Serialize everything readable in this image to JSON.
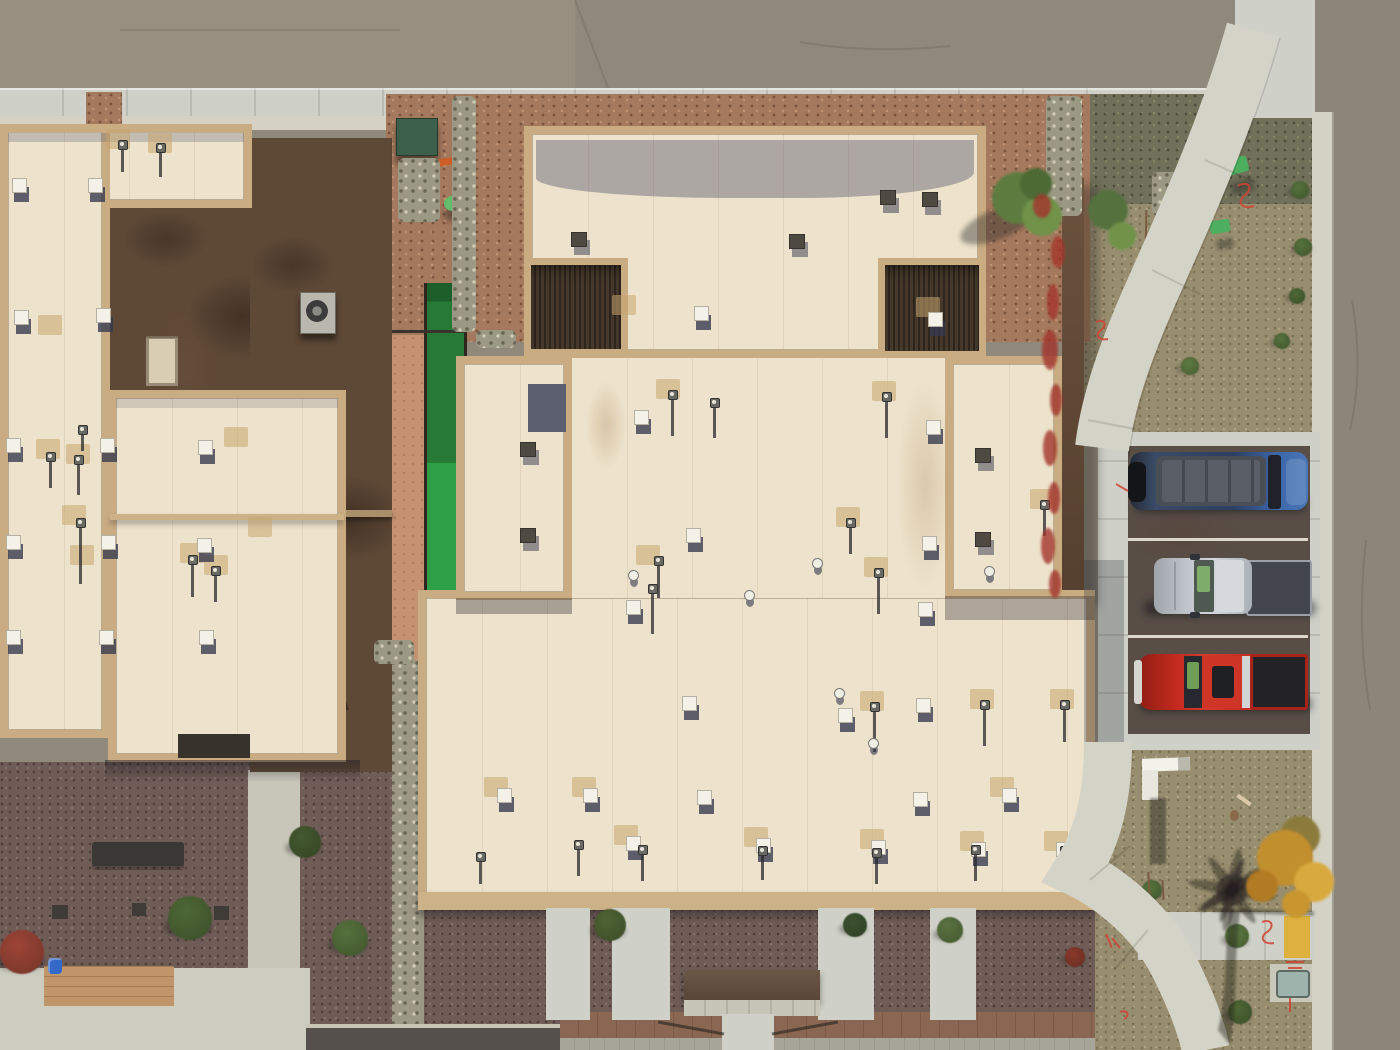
{
  "meta": {
    "description": "Aerial top-down drone photo of two flat-roofed desert buildings, a street corner with curving sidewalks, three parked vehicles, and xeriscape landscaping",
    "text_visible_in_image": []
  },
  "palette": {
    "street": "#8f897c",
    "streetTint": "#988f80",
    "rightStreet": "#8b8679",
    "concrete": "#cfd1c8",
    "walk": "#d4d3c7",
    "curb": "#d4d2c5",
    "cream": "#ede2cb",
    "tan": "#c9ac82",
    "fascia": "#cdb187",
    "gravelRed": "#a5795d",
    "gravelOlive": "#71705a",
    "gravelKhaki": "#978d6f",
    "gravelPlum": "#6f5c56",
    "salmon": "#c49171",
    "turfDark": "#277a35",
    "turfBright": "#2fa046",
    "parkAsphalt": "#584e46",
    "lineWhite": "#dbd8cb",
    "shadow": "rgba(40,38,48,0.38)",
    "sprayRed": "#cf4434",
    "rampYellow": "#ddb13e",
    "utilGreen": "#4cae5e",
    "boxGreen": "#3d604c",
    "pipeOrange": "#cf5d28",
    "bucketBlue": "#3468c9"
  },
  "sprites": {
    "vents_cream": [
      [
        6,
        438
      ],
      [
        100,
        438
      ],
      [
        198,
        440
      ],
      [
        6,
        535
      ],
      [
        101,
        535
      ],
      [
        197,
        538
      ],
      [
        6,
        630
      ],
      [
        99,
        630
      ],
      [
        199,
        630
      ],
      [
        12,
        178
      ],
      [
        88,
        178
      ],
      [
        14,
        310
      ],
      [
        96,
        308
      ],
      [
        694,
        306
      ],
      [
        928,
        312
      ],
      [
        634,
        410
      ],
      [
        926,
        420
      ],
      [
        686,
        528
      ],
      [
        922,
        536
      ],
      [
        626,
        600
      ],
      [
        918,
        602
      ],
      [
        682,
        696
      ],
      [
        916,
        698
      ],
      [
        697,
        790
      ],
      [
        913,
        792
      ],
      [
        626,
        836
      ],
      [
        756,
        838
      ],
      [
        871,
        840
      ],
      [
        971,
        842
      ],
      [
        1056,
        842
      ],
      [
        497,
        788
      ],
      [
        583,
        788
      ],
      [
        1002,
        788
      ],
      [
        838,
        708
      ]
    ],
    "vents_dark": [
      [
        880,
        190
      ],
      [
        922,
        192
      ],
      [
        975,
        448
      ],
      [
        975,
        532
      ],
      [
        520,
        442
      ],
      [
        520,
        528
      ],
      [
        571,
        232
      ],
      [
        789,
        234
      ]
    ],
    "pipes": [
      [
        48,
        452,
        30
      ],
      [
        76,
        455,
        34
      ],
      [
        78,
        518,
        60
      ],
      [
        190,
        555,
        36
      ],
      [
        213,
        566,
        30
      ],
      [
        120,
        140,
        26
      ],
      [
        158,
        143,
        28
      ],
      [
        80,
        425,
        20
      ],
      [
        670,
        390,
        40
      ],
      [
        884,
        392,
        40
      ],
      [
        712,
        398,
        34
      ],
      [
        656,
        556,
        36
      ],
      [
        650,
        584,
        44
      ],
      [
        848,
        518,
        30
      ],
      [
        876,
        568,
        40
      ],
      [
        1042,
        500,
        30
      ],
      [
        872,
        702,
        44
      ],
      [
        982,
        700,
        40
      ],
      [
        1062,
        700,
        36
      ],
      [
        640,
        845,
        30
      ],
      [
        760,
        846,
        28
      ],
      [
        874,
        848,
        30
      ],
      [
        973,
        845,
        30
      ],
      [
        1062,
        846,
        28
      ],
      [
        478,
        852,
        26
      ],
      [
        576,
        840,
        30
      ]
    ],
    "caps": [
      [
        628,
        570
      ],
      [
        812,
        558
      ],
      [
        744,
        590
      ],
      [
        984,
        566
      ],
      [
        834,
        688
      ],
      [
        868,
        738
      ]
    ],
    "patches": [
      [
        40,
        442
      ],
      [
        70,
        447
      ],
      [
        66,
        508
      ],
      [
        74,
        548
      ],
      [
        184,
        546
      ],
      [
        208,
        558
      ],
      [
        110,
        132
      ],
      [
        152,
        136
      ],
      [
        42,
        318
      ],
      [
        660,
        382
      ],
      [
        876,
        384
      ],
      [
        640,
        548
      ],
      [
        840,
        510
      ],
      [
        868,
        560
      ],
      [
        1034,
        492
      ],
      [
        864,
        694
      ],
      [
        974,
        692
      ],
      [
        1054,
        692
      ],
      [
        616,
        298
      ],
      [
        920,
        300
      ],
      [
        488,
        780
      ],
      [
        576,
        780
      ],
      [
        994,
        780
      ],
      [
        618,
        828
      ],
      [
        748,
        830
      ],
      [
        864,
        832
      ],
      [
        964,
        834
      ],
      [
        1048,
        834
      ],
      [
        228,
        430
      ],
      [
        252,
        520
      ]
    ],
    "shrubs": [
      {
        "x": 1300,
        "y": 190,
        "r": 9,
        "c": "#55713c"
      },
      {
        "x": 1303,
        "y": 247,
        "r": 9,
        "c": "#55713c"
      },
      {
        "x": 1297,
        "y": 296,
        "r": 8,
        "c": "#4e6836"
      },
      {
        "x": 1282,
        "y": 341,
        "r": 8,
        "c": "#55713c"
      },
      {
        "x": 1190,
        "y": 366,
        "r": 9,
        "c": "#5d7a42"
      },
      {
        "x": 1152,
        "y": 890,
        "r": 10,
        "c": "#55713c"
      },
      {
        "x": 1237,
        "y": 936,
        "r": 12,
        "c": "#5d7a42"
      },
      {
        "x": 1240,
        "y": 1012,
        "r": 12,
        "c": "#4e6836"
      },
      {
        "x": 610,
        "y": 925,
        "r": 16,
        "c": "#4f6434"
      },
      {
        "x": 855,
        "y": 925,
        "r": 12,
        "c": "#3c5230"
      },
      {
        "x": 950,
        "y": 930,
        "r": 13,
        "c": "#5a7340"
      },
      {
        "x": 190,
        "y": 918,
        "r": 22,
        "c": "#4e6836"
      },
      {
        "x": 305,
        "y": 842,
        "r": 16,
        "c": "#44592f"
      },
      {
        "x": 350,
        "y": 938,
        "r": 18,
        "c": "#55713c"
      },
      {
        "x": 22,
        "y": 952,
        "r": 22,
        "c": "#9c4536"
      },
      {
        "x": 1075,
        "y": 957,
        "r": 10,
        "c": "#8a3a2c"
      }
    ],
    "sticks": [
      [
        1145,
        210,
        42
      ],
      [
        1160,
        228,
        52
      ],
      [
        1174,
        248,
        46
      ],
      [
        1152,
        278,
        36
      ],
      [
        1148,
        872,
        26
      ],
      [
        1162,
        880,
        20
      ]
    ],
    "rocks": [
      [
        1152,
        172,
        64,
        44
      ],
      [
        1046,
        96,
        36,
        120
      ],
      [
        452,
        96,
        24,
        236
      ],
      [
        398,
        158,
        42,
        64
      ],
      [
        476,
        330,
        40,
        18
      ],
      [
        374,
        640,
        40,
        24
      ]
    ]
  },
  "vehicles": [
    {
      "kind": "van",
      "name": "blue-van",
      "x": 1128,
      "y": 450,
      "body": "#2c3f63",
      "front": "#3b66a8",
      "roof": "#4a4e55",
      "roofInner": "#5a5e66",
      "tire": "#141519",
      "glass": "#1f2329"
    },
    {
      "kind": "pickup-covered",
      "name": "silver-truck",
      "x": 1138,
      "y": 554,
      "body": "#c6cad0",
      "hood": "#aab0b6",
      "roof": "#d5d9dd",
      "bed": "#43464c",
      "trim": "#9aa0a6",
      "glass": "#4e5a52",
      "glint": "#7fae6a"
    },
    {
      "kind": "pickup-open",
      "name": "red-truck",
      "x": 1134,
      "y": 650,
      "body": "#c42a1e",
      "hood": "#a92318",
      "roof": "#cf3526",
      "bed": "#232327",
      "bumper": "#d6d5cf",
      "chrome": "#d3d4d6",
      "glass": "#262a30",
      "glint": "#6f9e55"
    }
  ],
  "landscape": {
    "tree_top_right": {
      "x": 1030,
      "y": 205,
      "greens": [
        "#5d7c3f",
        "#6f9249",
        "#4e6b34"
      ]
    },
    "yellow_bush": {
      "x": 1290,
      "y": 862,
      "colors": [
        "#c28f2e",
        "#d8a93c",
        "#b27a24",
        "#8a7a3a"
      ]
    },
    "palm_shadow_origin": [
      1232,
      886
    ],
    "mailbox": {
      "x": 1142,
      "y": 758
    },
    "utility_pad": {
      "x": 1270,
      "y": 964,
      "box": "#9db3ab"
    },
    "green_utilities": [
      [
        1222,
        158
      ],
      [
        1210,
        220
      ]
    ],
    "transformer_box": [
      396,
      118
    ],
    "green_dome": [
      444,
      196
    ],
    "orange_pipe": [
      436,
      158
    ],
    "ac_unit": [
      300,
      292
    ],
    "bench": [
      92,
      842
    ],
    "bucket": [
      48,
      958
    ],
    "window_on_wall": [
      146,
      336
    ]
  }
}
